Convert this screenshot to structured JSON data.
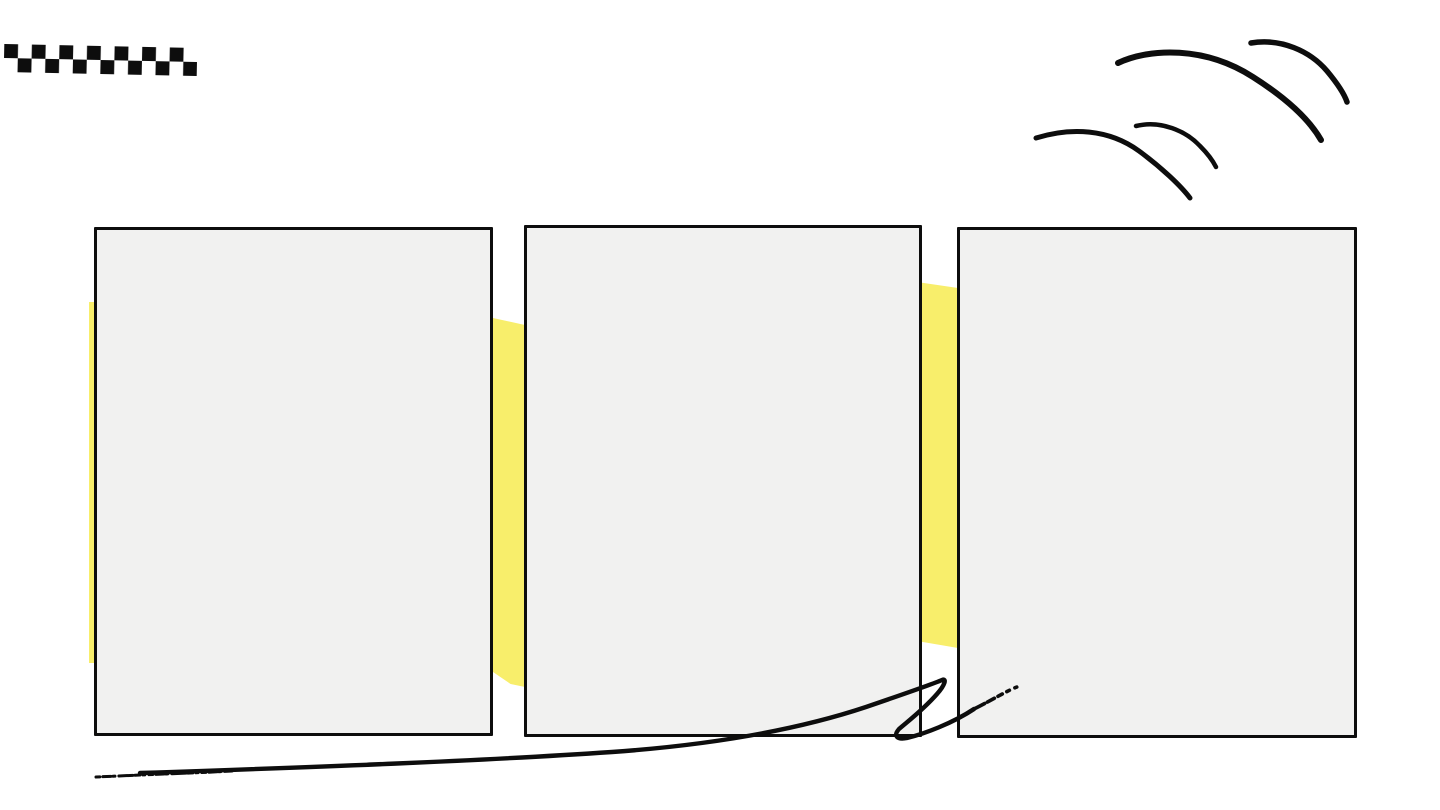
{
  "page": {
    "type": "slide-canvas",
    "background": "#ffffff"
  },
  "colors": {
    "ink": "#0d0d0d",
    "highlight": "#f8ee6b",
    "panel_fill": "#f1f1f0",
    "page_bg": "#ffffff"
  },
  "panels": [
    {
      "name": "panel-1",
      "text": ""
    },
    {
      "name": "panel-2",
      "text": ""
    },
    {
      "name": "panel-3",
      "text": ""
    }
  ],
  "decorations": [
    {
      "name": "checkered-flag",
      "rows": 2,
      "cols": 14,
      "color": "#0d0d0d"
    },
    {
      "name": "double-arc-swoosh-top-right",
      "arc_count": 4,
      "color": "#0d0d0d"
    },
    {
      "name": "highlighter-band",
      "visible_segments": 3,
      "color": "#f8ee6b"
    },
    {
      "name": "swoosh-flourish-bottom",
      "style": "hand-drawn, dry-brush ends, loop near right end",
      "color": "#0d0d0d"
    }
  ]
}
